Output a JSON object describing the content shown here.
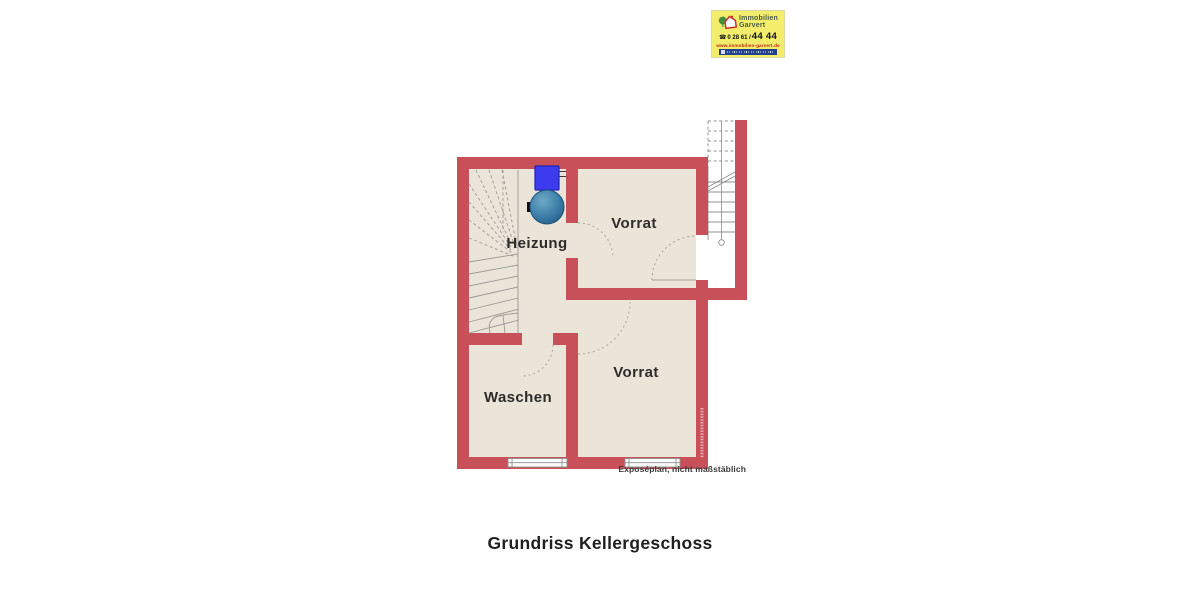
{
  "logo": {
    "name_line1": "Immobilien",
    "name_line2": "Garvert",
    "phone_icon": "☎",
    "phone_small": "0 28 61 /",
    "phone_large": "44 44",
    "website": "www.immobilien-garvert.de"
  },
  "plan": {
    "room_heizung": "Heizung",
    "room_vorrat_top": "Vorrat",
    "room_vorrat_bottom": "Vorrat",
    "room_waschen": "Waschen",
    "disclaimer": "Exposéplan, nicht maßstäblich"
  },
  "caption": "Grundriss Kellergeschoss",
  "colors": {
    "wall_red": "#c85058",
    "floor_beige": "#eae4d9",
    "boiler_blue": "#3c3cee",
    "tank_blue": "#3e80aa",
    "logo_yellow": "#f2ed6b",
    "logo_url_red": "#c2281f",
    "membership_bar_blue": "#23418f"
  }
}
